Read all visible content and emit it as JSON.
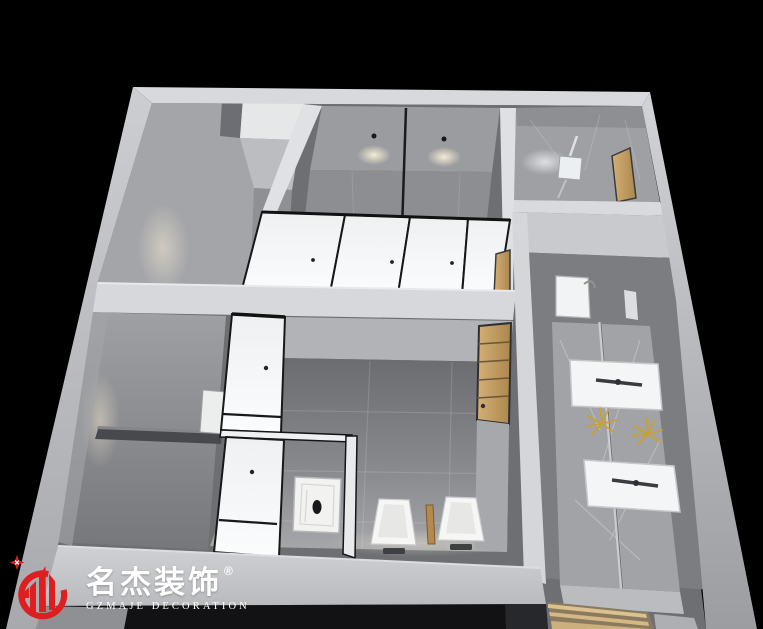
{
  "brand": {
    "logo_emblem_icon": "buildings-in-open-ring-icon",
    "logo_sparkle_icon": "four-point-star-icon",
    "name_cn": "名杰装饰",
    "registered_mark": "®",
    "name_en": "GZMAJE DECORATION",
    "brand_red": "#dd1f1f",
    "text_white": "#ffffff"
  },
  "scene": {
    "type": "3d-dollhouse-interior-render",
    "subject": "public-restroom-floor-plan-aerial-view",
    "background_color": "#000000",
    "palette": {
      "outer_wall": "#c6c7cb",
      "inner_wall": "#a6a7ab",
      "floor_tile": "#8f9094",
      "partition_white": "#f3f4f6",
      "partition_trim": "#17181a",
      "marble": "#a2a3a7",
      "wood": "#c9a76b",
      "fixture_white": "#f6f6f4",
      "accent_gold": "#c9a227",
      "downlight_warm": "#fff3d8"
    }
  }
}
